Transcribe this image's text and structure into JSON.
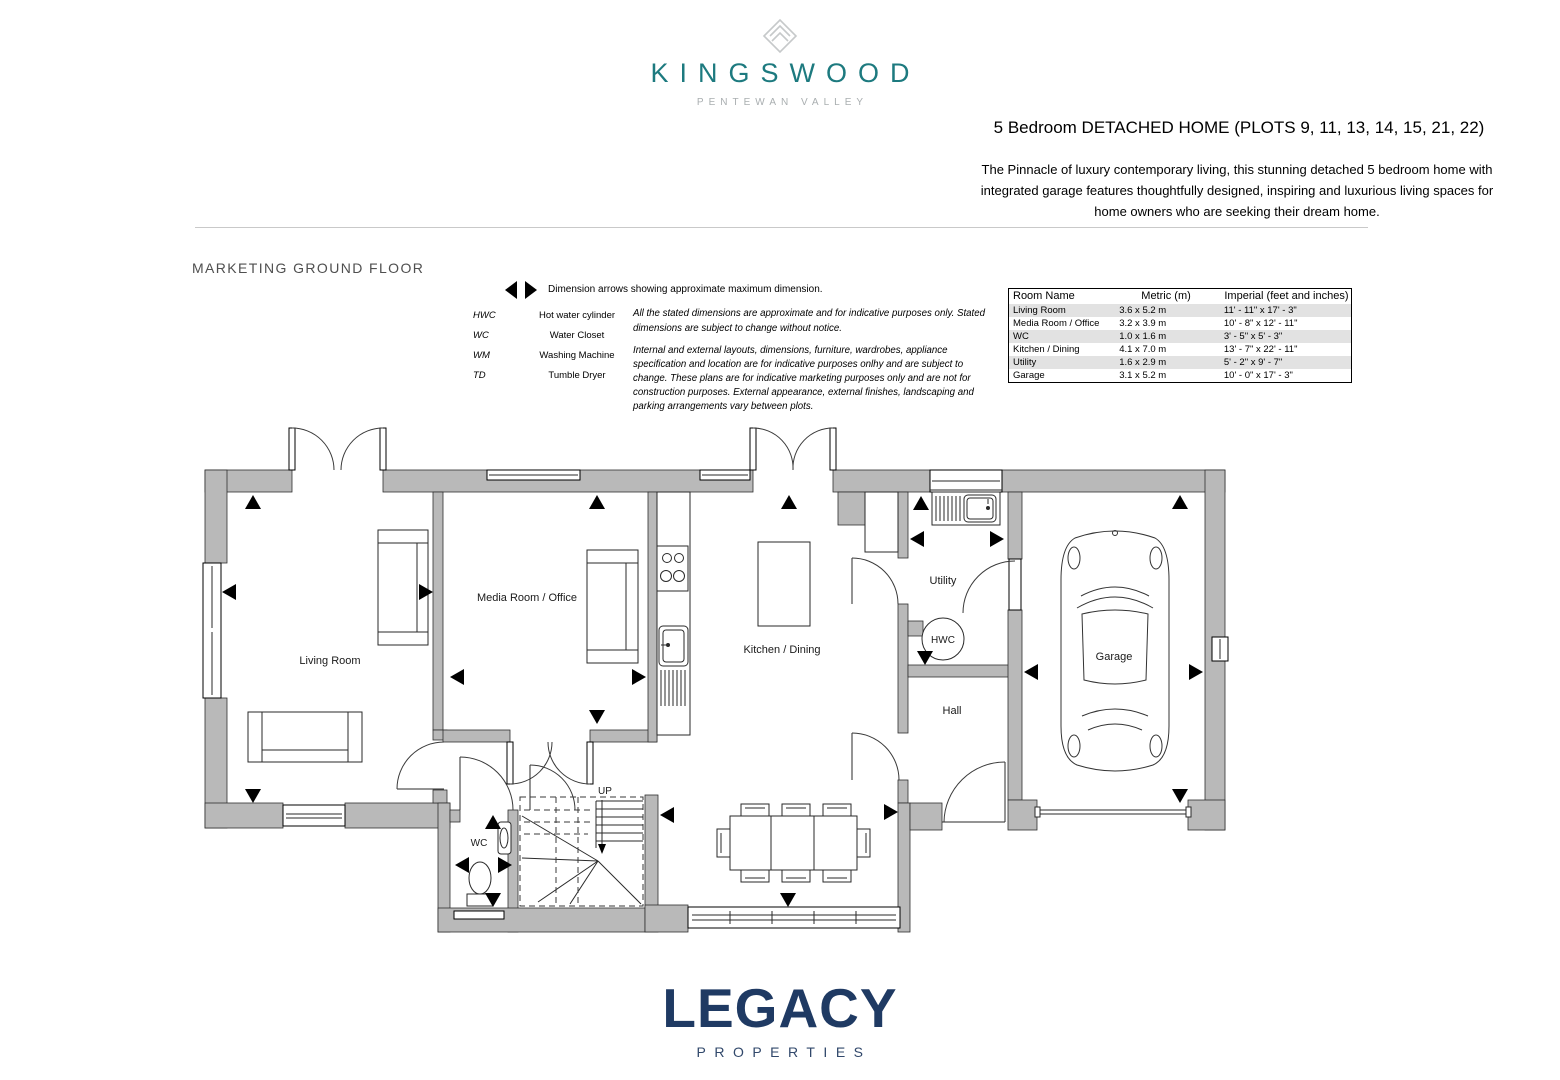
{
  "brand": {
    "name": "KINGSWOOD",
    "tagline": "PENTEWAN VALLEY",
    "teal": "#1d7a7f",
    "mark_gray": "#c6c9ca"
  },
  "header": {
    "title": "5 Bedroom DETACHED HOME (PLOTS 9, 11, 13, 14, 15, 21, 22)",
    "description": "The Pinnacle of luxury contemporary living, this stunning detached 5 bedroom home with integrated garage features thoughtfully designed, inspiring and luxurious living spaces for home owners who are seeking their dream home."
  },
  "plan": {
    "heading": "MARKETING GROUND FLOOR",
    "legend": {
      "arrows_note": "Dimension arrows showing approximate maximum dimension.",
      "items": [
        {
          "abbr": "HWC",
          "label": "Hot water cylinder"
        },
        {
          "abbr": "WC",
          "label": "Water Closet"
        },
        {
          "abbr": "WM",
          "label": "Washing Machine"
        },
        {
          "abbr": "TD",
          "label": "Tumble Dryer"
        }
      ],
      "disclaimer1": "All the stated dimensions are approximate and for indicative purposes only. Stated dimensions are subject to change without notice.",
      "disclaimer2": "Internal and external layouts, dimensions, furniture, wardrobes, appliance specification and location are for indicative purposes onlhy and are subject to change. These plans are for indicative marketing purposes only and are not for construction purposes. External appearance, external finishes, landscaping and parking arrangements vary between plots."
    },
    "rooms": {
      "living": "Living Room",
      "media": "Media Room / Office",
      "kitchen": "Kitchen / Dining",
      "utility": "Utility",
      "hwc": "HWC",
      "hall": "Hall",
      "garage": "Garage",
      "wc": "WC",
      "up": "UP"
    },
    "wall_gray": "#b9b9b9"
  },
  "dimensions_table": {
    "headers": [
      "Room Name",
      "Metric (m)",
      "Imperial (feet and inches)"
    ],
    "rows": [
      [
        "Living Room",
        "3.6 x 5.2 m",
        "11' - 11\" x 17' - 3\""
      ],
      [
        "Media Room / Office",
        "3.2 x 3.9 m",
        "10' - 8\" x 12' - 11\""
      ],
      [
        "WC",
        "1.0 x 1.6 m",
        "3' - 5\" x 5' - 3\""
      ],
      [
        "Kitchen / Dining",
        "4.1 x 7.0 m",
        "13' - 7\" x 22' - 11\""
      ],
      [
        "Utility",
        "1.6 x 2.9 m",
        "5' - 2\" x 9' - 7\""
      ],
      [
        "Garage",
        "3.1 x 5.2 m",
        "10' - 0\" x 17' - 3\""
      ]
    ]
  },
  "footer": {
    "brand": "LEGACY",
    "tagline": "PROPERTIES",
    "navy": "#1f3a63"
  }
}
